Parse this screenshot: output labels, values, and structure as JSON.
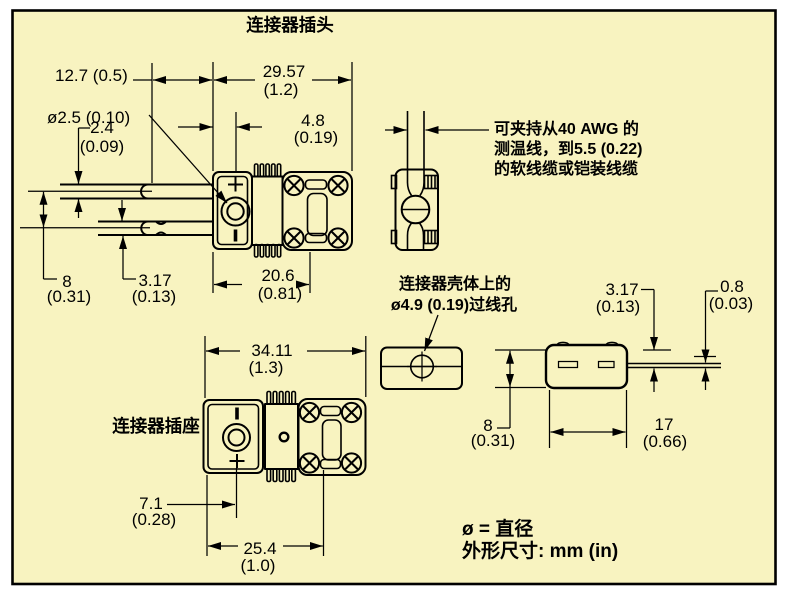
{
  "colors": {
    "panel_fill": "#f8f3c0",
    "line_ink": "#000000",
    "page": "#ffffff"
  },
  "titles": {
    "plug": "连接器插头",
    "socket": "连接器插座"
  },
  "notes": {
    "clamp": [
      "可夹持从40 AWG 的",
      "测温线，到5.5 (0.22)",
      "的软线缆或铠装线缆"
    ],
    "grommet": [
      "连接器壳体上的",
      "ø4.9 (0.19)过线孔"
    ]
  },
  "legend": {
    "diameter": "ø = 直径",
    "units": "外形尺寸: mm (in)"
  },
  "dims": {
    "plug_pin_length": "12.7 (0.5)",
    "pin_hole_diameter": "ø2.5 (0.10)",
    "plug_body_length": {
      "mm": "29.57",
      "in": "(1.2)"
    },
    "plus_pin_thickness": {
      "mm": "2.4",
      "in": "(0.09)"
    },
    "face_to_center": {
      "mm": "4.8",
      "in": "(0.19)"
    },
    "pin_spacing": {
      "mm": "8",
      "in": "(0.31)"
    },
    "minus_pin_thickness": {
      "mm": "3.17",
      "in": "(0.13)"
    },
    "clamp_section_length": {
      "mm": "20.6",
      "in": "(0.81)"
    },
    "socket_length": {
      "mm": "34.11",
      "in": "(1.3)"
    },
    "socket_center_offset": {
      "mm": "7.1",
      "in": "(0.28)"
    },
    "socket_screw_span": {
      "mm": "25.4",
      "in": "(1.0)"
    },
    "side_top_to_blade": {
      "mm": "3.17",
      "in": "(0.13)"
    },
    "blade_thickness": {
      "mm": "0.8",
      "in": "(0.03)"
    },
    "side_height": {
      "mm": "8",
      "in": "(0.31)"
    },
    "side_length": {
      "mm": "17",
      "in": "(0.66)"
    }
  }
}
